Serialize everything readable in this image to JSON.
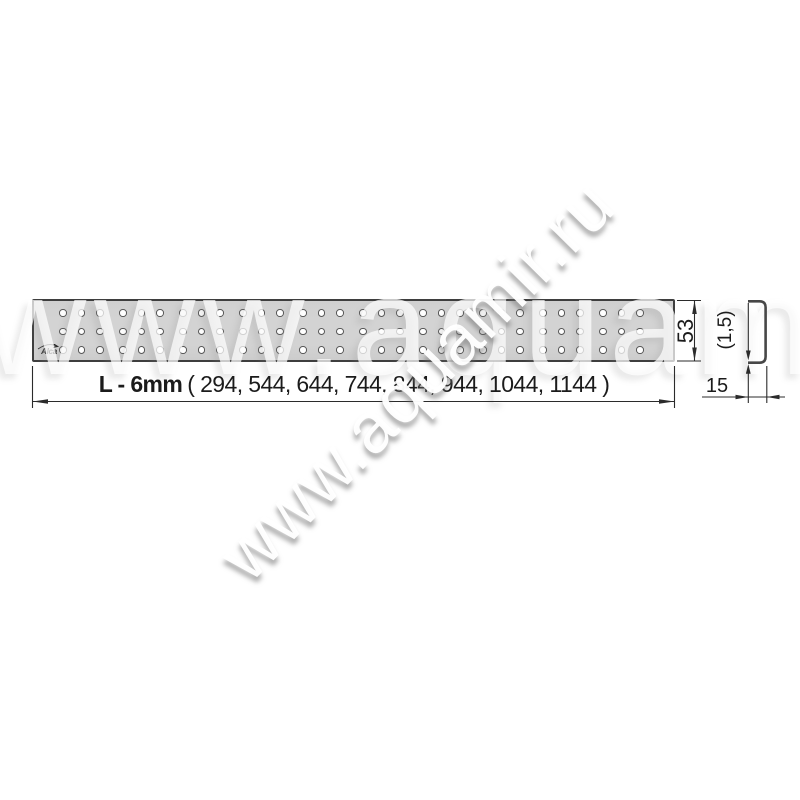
{
  "watermark": {
    "diagonal_text": "www.aquamir.ru",
    "giant_text": "www.aquamir.ru"
  },
  "grate": {
    "logo": "Alca",
    "holes": {
      "groups": 10,
      "cols_per_group": 3,
      "rows": 3,
      "start_x": 29,
      "group_pitch": 60,
      "col_pitch": 18.5,
      "start_y": 12,
      "row_pitch": 18.5,
      "diameter": 7.4
    }
  },
  "dimensions": {
    "length_bold": "L - 6mm",
    "length_values": "( 294, 544, 644, 744, 844, 944, 1044, 1144 )",
    "height": "53",
    "profile_thickness": "(1,5)",
    "profile_width": "15"
  },
  "colors": {
    "grate_fill": "#d3d3d3",
    "grate_border": "#3e3e3e",
    "line": "#2b2b2b",
    "hole_ring": "#575757"
  }
}
